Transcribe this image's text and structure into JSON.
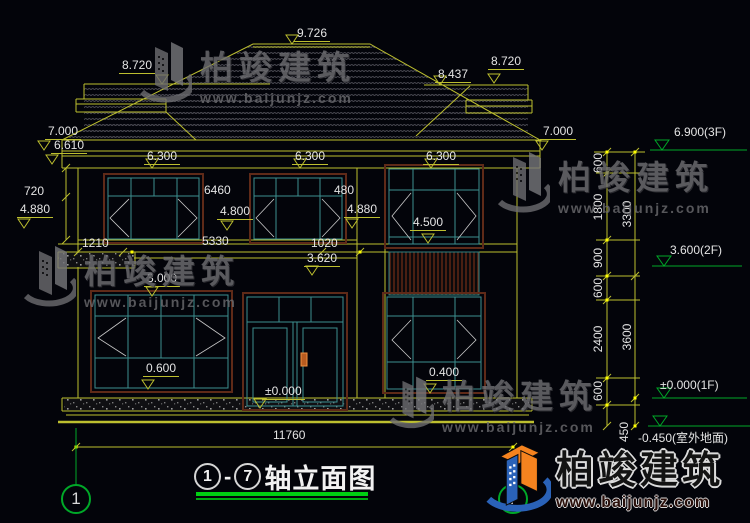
{
  "watermark": {
    "brand": "柏竣建筑",
    "url": "www.baijunjz.com"
  },
  "logo": {
    "brand": "柏竣建筑",
    "url": "www.baijunjz.com"
  },
  "title": {
    "axis_from": "1",
    "dash": "-",
    "axis_to": "7",
    "name": "轴立面图"
  },
  "axis_bubbles": {
    "left": "1",
    "right": "7"
  },
  "roof_dims": {
    "ridge": "9.726",
    "left_wing": "8.720",
    "right_wing_inner": "8.437",
    "right_wing_outer": "8.720"
  },
  "eave_dims": {
    "left_upper": "7.000",
    "left_lower": "6.610",
    "right": "7.000",
    "band_left": "6.300",
    "band_mid": "6.300",
    "band_right": "6.300"
  },
  "floor2_dims": {
    "jamb": "720",
    "sill_left": "4.880",
    "opening_width": "6460",
    "head": "4.800",
    "jamb_right": "480",
    "sill_right": "4.880",
    "bay_sill": "4.500",
    "seg_left": "1210",
    "seg_mid": "5330",
    "seg_right": "1020",
    "rail_top": "3.620",
    "slab_top": "3.000"
  },
  "floor1_dims": {
    "sill_left": "0.600",
    "door_level": "±0.000",
    "sill_right": "0.400"
  },
  "bottom": {
    "total_width": "11760"
  },
  "right_chain": {
    "seg1": "600",
    "seg2": "1800",
    "seg3": "900",
    "seg4": "600",
    "seg5": "2400",
    "seg6": "600",
    "seg7": "450",
    "total_upper": "3300",
    "total_lower": "3600"
  },
  "levels": {
    "f3": "6.900(3F)",
    "f2": "3.600(2F)",
    "f1": "±0.000(1F)",
    "ground": "-0.450(室外地面)"
  }
}
